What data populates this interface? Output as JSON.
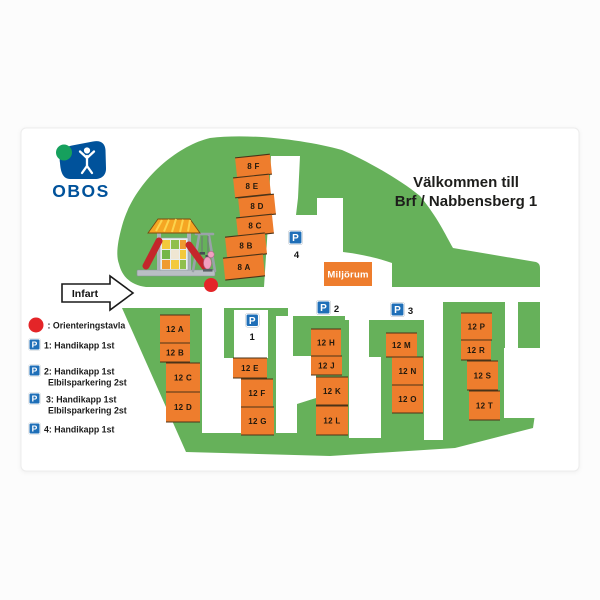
{
  "brand": {
    "name": "OBOS"
  },
  "title": {
    "line1": "Välkommen till",
    "line2": "Brf / Nabbensberg 1"
  },
  "map": {
    "infart_label": "Infart",
    "miljorum_label": "Miljörum",
    "p_symbol": "P",
    "buildings_8": [
      "8 F",
      "8 E",
      "8 D",
      "8 C",
      "8 B",
      "8 A"
    ],
    "buildings_12": [
      "12 A",
      "12 B",
      "12 C",
      "12 D",
      "12 E",
      "12 F",
      "12 G",
      "12 H",
      "12 J",
      "12 K",
      "12 L",
      "12 M",
      "12 N",
      "12 O",
      "12 P",
      "12 R",
      "12 S",
      "12 T"
    ],
    "parking_signs": [
      {
        "number": "1"
      },
      {
        "number": "2"
      },
      {
        "number": "3"
      },
      {
        "number": "4"
      }
    ]
  },
  "legend": {
    "p_symbol": "P",
    "items": [
      {
        "icon": "red-dot",
        "text": ": Orienteringstavla",
        "text2": ""
      },
      {
        "icon": "p-sign",
        "text": "1: Handikapp 1st",
        "text2": ""
      },
      {
        "icon": "p-sign",
        "text": "2: Handikapp 1st",
        "text2": "Elbilsparkering 2st"
      },
      {
        "icon": "p-sign",
        "text": "3: Handikapp 1st",
        "text2": "Elbilsparkering 2st"
      },
      {
        "icon": "p-sign",
        "text": "4: Handikapp 1st",
        "text2": ""
      }
    ]
  },
  "colors": {
    "green": "#66b15a",
    "orange": "#ee7d2d",
    "building_line": "#4a3318",
    "sign_blue": "#1f6fb8",
    "obos_blue": "#00529b",
    "logo_green": "#16a05d",
    "red": "#e42528",
    "card_border": "#ececec",
    "text_dark": "#1d1d1b"
  }
}
